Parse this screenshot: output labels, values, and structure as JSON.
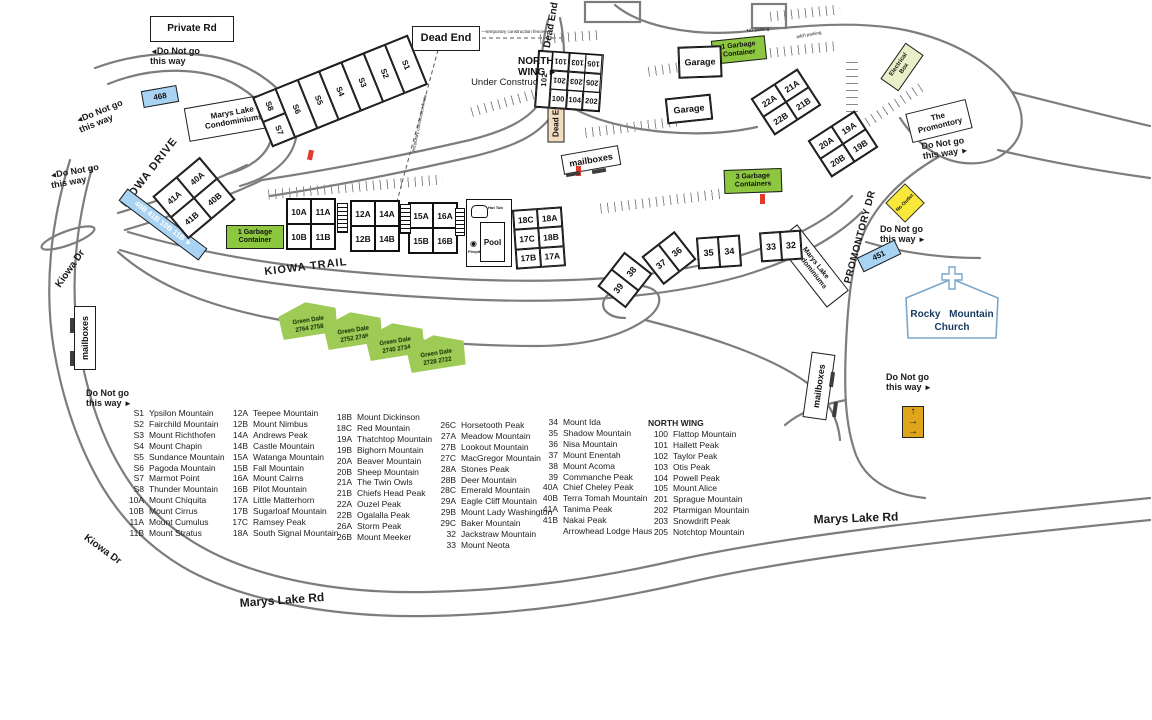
{
  "legend": {
    "columns": [
      {
        "x": 124,
        "y": 408,
        "header": "",
        "items": [
          {
            "code": "S1",
            "name": "Ypsilon Mountain"
          },
          {
            "code": "S2",
            "name": "Fairchild Mountain"
          },
          {
            "code": "S3",
            "name": "Mount Richthofen"
          },
          {
            "code": "S4",
            "name": "Mount Chapin"
          },
          {
            "code": "S5",
            "name": "Sundance Mountain"
          },
          {
            "code": "S6",
            "name": "Pagoda Mountain"
          },
          {
            "code": "S7",
            "name": "Marmot Point"
          },
          {
            "code": "S8",
            "name": "Thunder Mountain"
          },
          {
            "code": "10A",
            "name": "Mount Chiquita"
          },
          {
            "code": "10B",
            "name": "Mount Cirrus"
          },
          {
            "code": "11A",
            "name": "Mount Cumulus"
          },
          {
            "code": "11B",
            "name": "Mount Stratus"
          }
        ]
      },
      {
        "x": 228,
        "y": 408,
        "header": "",
        "items": [
          {
            "code": "12A",
            "name": "Teepee Mountain"
          },
          {
            "code": "12B",
            "name": "Mount Nimbus"
          },
          {
            "code": "14A",
            "name": "Andrews Peak"
          },
          {
            "code": "14B",
            "name": "Castle Mountain"
          },
          {
            "code": "15A",
            "name": "Watanga Mountain"
          },
          {
            "code": "15B",
            "name": "Fall Mountain"
          },
          {
            "code": "16A",
            "name": "Mount Cairns"
          },
          {
            "code": "16B",
            "name": "Pilot Mountain"
          },
          {
            "code": "17A",
            "name": "Little Matterhorn"
          },
          {
            "code": "17B",
            "name": "Sugarloaf Mountain"
          },
          {
            "code": "17C",
            "name": "Ramsey Peak"
          },
          {
            "code": "18A",
            "name": "South Signal Mountain"
          }
        ]
      },
      {
        "x": 332,
        "y": 412,
        "header": "",
        "items": [
          {
            "code": "18B",
            "name": "Mount Dickinson"
          },
          {
            "code": "18C",
            "name": "Red Mountain"
          },
          {
            "code": "19A",
            "name": "Thatchtop Mountain"
          },
          {
            "code": "19B",
            "name": "Bighorn Mountain"
          },
          {
            "code": "20A",
            "name": "Beaver Mountain"
          },
          {
            "code": "20B",
            "name": "Sheep Mountain"
          },
          {
            "code": "21A",
            "name": "The Twin Owls"
          },
          {
            "code": "21B",
            "name": "Chiefs Head Peak"
          },
          {
            "code": "22A",
            "name": "Ouzel Peak"
          },
          {
            "code": "22B",
            "name": "Ogalalla Peak"
          },
          {
            "code": "26A",
            "name": "Storm Peak"
          },
          {
            "code": "26B",
            "name": "Mount Meeker"
          }
        ]
      },
      {
        "x": 436,
        "y": 420,
        "header": "",
        "items": [
          {
            "code": "26C",
            "name": "Horsetooth Peak"
          },
          {
            "code": "27A",
            "name": "Meadow Mountain"
          },
          {
            "code": "27B",
            "name": "Lookout Mountain"
          },
          {
            "code": "27C",
            "name": "MacGregor Mountain"
          },
          {
            "code": "28A",
            "name": "Stones Peak"
          },
          {
            "code": "28B",
            "name": "Deer Mountain"
          },
          {
            "code": "28C",
            "name": "Emerald Mountain"
          },
          {
            "code": "29A",
            "name": "Eagle Cliff Mountain"
          },
          {
            "code": "29B",
            "name": "Mount Lady Washington"
          },
          {
            "code": "29C",
            "name": "Baker Mountain"
          },
          {
            "code": "32",
            "name": "Jackstraw Mountain"
          },
          {
            "code": "33",
            "name": "Mount Neota"
          }
        ]
      },
      {
        "x": 538,
        "y": 417,
        "header": "",
        "items": [
          {
            "code": "34",
            "name": "Mount Ida"
          },
          {
            "code": "35",
            "name": "Shadow Mountain"
          },
          {
            "code": "36",
            "name": "Nisa Mountain"
          },
          {
            "code": "37",
            "name": "Mount Enentah"
          },
          {
            "code": "38",
            "name": "Mount Acoma"
          },
          {
            "code": "39",
            "name": "Commanche Peak"
          },
          {
            "code": "40A",
            "name": "Chief Cheley Peak"
          },
          {
            "code": "40B",
            "name": "Terra Tomah Mountain"
          },
          {
            "code": "41A",
            "name": "Tanima Peak"
          },
          {
            "code": "41B",
            "name": "Nakai Peak"
          },
          {
            "code": "",
            "name": "Arrowhead Lodge Haus"
          }
        ]
      },
      {
        "x": 648,
        "y": 418,
        "header": "NORTH WING",
        "items": [
          {
            "code": "100",
            "name": "Flattop Mountain"
          },
          {
            "code": "101",
            "name": "Hallett Peak"
          },
          {
            "code": "102",
            "name": "Taylor Peak"
          },
          {
            "code": "103",
            "name": "Otis Peak"
          },
          {
            "code": "104",
            "name": "Powell Peak"
          },
          {
            "code": "105",
            "name": "Mount Alice"
          },
          {
            "code": "201",
            "name": "Sprague Mountain"
          },
          {
            "code": "202",
            "name": "Ptarmigan Mountain"
          },
          {
            "code": "203",
            "name": "Snowdrift Peak"
          },
          {
            "code": "205",
            "name": "Notchtop Mountain"
          }
        ]
      }
    ]
  },
  "map": {
    "colors": {
      "blue_sign": "#a9d3f2",
      "green_sign": "#8dc63f",
      "tan_sign": "#f2ddc0",
      "yellow_sign": "#f7e83a",
      "orange_sign": "#dfa61c",
      "khaki_sign": "#e9efc8",
      "red_marker": "#e23b2e"
    },
    "road_labels": [
      {
        "text": "KIOWA DRIVE",
        "x": 100,
        "y": 167,
        "w": 100,
        "rot": -52,
        "fs": 11,
        "sp": 1
      },
      {
        "text": "Kiowa Dr",
        "x": 38,
        "y": 264,
        "w": 66,
        "rot": -55,
        "fs": 10
      },
      {
        "text": "Kiowa Dr",
        "x": 70,
        "y": 545,
        "w": 64,
        "rot": 36,
        "fs": 10
      },
      {
        "text": "KIOWA TRAIL",
        "x": 258,
        "y": 262,
        "w": 96,
        "rot": -7,
        "fs": 11,
        "sp": 1
      },
      {
        "text": "Marys Lake Rd",
        "x": 226,
        "y": 594,
        "w": 112,
        "rot": -4,
        "fs": 12
      },
      {
        "text": "Marys Lake Rd",
        "x": 800,
        "y": 512,
        "w": 112,
        "rot": -2,
        "fs": 12
      },
      {
        "text": "PROMONTORY DR",
        "x": 806,
        "y": 232,
        "w": 110,
        "rot": -75,
        "fs": 10,
        "sp": 0.5
      },
      {
        "text": "Dead End",
        "x": 520,
        "y": 20,
        "w": 64,
        "rot": -80,
        "fs": 10
      },
      {
        "text": "Under Construction",
        "x": 452,
        "y": 78,
        "w": 120,
        "rot": 0,
        "fs": 9.5,
        "wt": 400
      },
      {
        "text": "—temporary construction fence—",
        "x": 455,
        "y": 30,
        "w": 120,
        "rot": 0,
        "fs": 4.5,
        "wt": 400
      },
      {
        "text": "temporary construction fence",
        "x": 370,
        "y": 121,
        "w": 100,
        "rot": -78,
        "fs": 4.5,
        "wt": 400
      },
      {
        "text": "NO parking",
        "x": 733,
        "y": 28,
        "w": 50,
        "rot": -5,
        "fs": 4.5,
        "wt": 400
      },
      {
        "text": "add'l parking",
        "x": 784,
        "y": 33,
        "w": 50,
        "rot": -10,
        "fs": 4.5,
        "wt": 400
      }
    ],
    "do_not_go": [
      {
        "x": 150,
        "y": 46,
        "rot": 0,
        "pre": "◄",
        "post": "",
        "l1": "Do Not go",
        "l2": "this way"
      },
      {
        "x": 76,
        "y": 106,
        "rot": -22,
        "pre": "◄",
        "post": "",
        "l1": "Do Not go",
        "l2": "this way"
      },
      {
        "x": 50,
        "y": 166,
        "rot": -10,
        "pre": "◄",
        "post": "",
        "l1": "Do Not go",
        "l2": "this way"
      },
      {
        "x": 86,
        "y": 388,
        "rot": 0,
        "pre": "",
        "post": "►",
        "l1": "Do Not go",
        "l2": "this way"
      },
      {
        "x": 922,
        "y": 138,
        "rot": -8,
        "pre": "",
        "post": "►",
        "l1": "Do Not go",
        "l2": "this way"
      },
      {
        "x": 880,
        "y": 224,
        "rot": 0,
        "pre": "",
        "post": "►",
        "l1": "Do Not go",
        "l2": "this way"
      },
      {
        "x": 886,
        "y": 372,
        "rot": 0,
        "pre": "",
        "post": "►",
        "l1": "Do Not go",
        "l2": "this way"
      }
    ],
    "signs": [
      {
        "dn": "sign-private-rd",
        "lines": [
          "Private Rd"
        ],
        "x": 150,
        "y": 16,
        "w": 84,
        "h": 26,
        "rot": 0,
        "fs": 10,
        "bg": "#ffffff"
      },
      {
        "dn": "sign-dead-end",
        "lines": [
          "Dead End"
        ],
        "x": 412,
        "y": 26,
        "w": 68,
        "h": 25,
        "rot": 0,
        "fs": 11,
        "bg": "#ffffff"
      },
      {
        "dn": "sign-marys-lake-condominiums",
        "lines": [
          "Marys Lake",
          "Condominiums"
        ],
        "x": 186,
        "y": 100,
        "w": 94,
        "h": 34,
        "rot": -10,
        "fs": 8,
        "bg": "#ffffff"
      },
      {
        "dn": "sign-the-promontory",
        "lines": [
          "The",
          "Promontory"
        ],
        "x": 908,
        "y": 106,
        "w": 62,
        "h": 30,
        "rot": -14,
        "fs": 8,
        "bg": "#ffffff"
      },
      {
        "dn": "sign-marys-lake-condominiums",
        "lines": [
          "Marys Lake",
          "Condominiums"
        ],
        "x": 770,
        "y": 252,
        "w": 84,
        "h": 28,
        "rot": 52,
        "fs": 7,
        "bg": "#ffffff"
      },
      {
        "dn": "sign-mailboxes",
        "lines": [
          "mailboxes"
        ],
        "x": 562,
        "y": 150,
        "w": 58,
        "h": 20,
        "rot": -10,
        "fs": 9,
        "bg": "#ffffff"
      },
      {
        "dn": "sign-mailboxes",
        "lines": [
          "mailboxes"
        ],
        "x": 53,
        "y": 327,
        "w": 64,
        "h": 22,
        "rot": -90,
        "fs": 9,
        "bg": "#ffffff"
      },
      {
        "dn": "sign-mailboxes",
        "lines": [
          "mailboxes"
        ],
        "x": 786,
        "y": 374,
        "w": 66,
        "h": 24,
        "rot": -82,
        "fs": 9,
        "bg": "#ffffff"
      },
      {
        "dn": "sign-dead-end",
        "lines": [
          "Dead End"
        ],
        "x": 532,
        "y": 110,
        "w": 48,
        "h": 17,
        "rot": -90,
        "fs": 8,
        "bg": "#f2ddc0"
      },
      {
        "dn": "sign-electrical-box",
        "lines": [
          "Electrical",
          "Box"
        ],
        "x": 880,
        "y": 56,
        "w": 44,
        "h": 22,
        "rot": -55,
        "fs": 6,
        "bg": "#e9efc8"
      },
      {
        "dn": "sign-468",
        "lines": [
          "468"
        ],
        "x": 142,
        "y": 88,
        "w": 36,
        "h": 17,
        "rot": -10,
        "fs": 8,
        "bg": "#a9d3f2"
      },
      {
        "dn": "sign-451",
        "lines": [
          "451"
        ],
        "x": 858,
        "y": 248,
        "w": 42,
        "h": 16,
        "rot": -26,
        "fs": 8,
        "bg": "#a9d3f2"
      },
      {
        "dn": "sign-units-direction",
        "lines": [
          "40B 41B 10B 11B ►"
        ],
        "x": 113,
        "y": 217,
        "w": 100,
        "h": 15,
        "rot": 37,
        "fs": 7.5,
        "bg": "#a9d3f2",
        "fg": "#ffffff"
      },
      {
        "dn": "sign-garbage-container",
        "lines": [
          "1 Garbage",
          "Container"
        ],
        "x": 712,
        "y": 38,
        "w": 54,
        "h": 24,
        "rot": -6,
        "fs": 7,
        "bg": "#8dc63f"
      },
      {
        "dn": "sign-garbage-container",
        "lines": [
          "1 Garbage",
          "Container"
        ],
        "x": 226,
        "y": 225,
        "w": 58,
        "h": 24,
        "rot": 0,
        "fs": 7,
        "bg": "#8dc63f"
      },
      {
        "dn": "sign-garbage-containers",
        "lines": [
          "3 Garbage",
          "Containers"
        ],
        "x": 724,
        "y": 169,
        "w": 58,
        "h": 24,
        "rot": -2,
        "fs": 7,
        "bg": "#8dc63f"
      }
    ],
    "green_dale": [
      {
        "l1": "Green Dale",
        "l2": "2764  2758",
        "x": 279,
        "y": 302,
        "rot": -9
      },
      {
        "l1": "Green Dale",
        "l2": "2752  2746",
        "x": 324,
        "y": 312,
        "rot": -9
      },
      {
        "l1": "Green Dale",
        "l2": "2740  2734",
        "x": 366,
        "y": 323,
        "rot": -9
      },
      {
        "l1": "Green Dale",
        "l2": "2728  2722",
        "x": 407,
        "y": 335,
        "rot": -9
      }
    ],
    "buildings": [
      {
        "dn": "building-40-41",
        "x": 163,
        "y": 170,
        "w": 62,
        "h": 56,
        "rot": -40,
        "cols": 2,
        "fs": 8.5,
        "units": [
          "41A",
          "40A",
          "41B",
          "40B"
        ]
      },
      {
        "dn": "building-10-11",
        "x": 286,
        "y": 198,
        "w": 50,
        "h": 52,
        "rot": 0,
        "cols": 2,
        "fs": 8.5,
        "units": [
          "10A",
          "11A",
          "10B",
          "11B"
        ]
      },
      {
        "dn": "building-12-14",
        "x": 350,
        "y": 200,
        "w": 50,
        "h": 52,
        "rot": 0,
        "cols": 2,
        "fs": 8.5,
        "units": [
          "12A",
          "14A",
          "12B",
          "14B"
        ]
      },
      {
        "dn": "building-15-16",
        "x": 408,
        "y": 202,
        "w": 50,
        "h": 52,
        "rot": 0,
        "cols": 2,
        "fs": 8.5,
        "units": [
          "15A",
          "16A",
          "15B",
          "16B"
        ]
      },
      {
        "dn": "building-17-18",
        "x": 514,
        "y": 208,
        "w": 50,
        "h": 60,
        "rot": -4,
        "cols": 2,
        "fs": 8.5,
        "units": [
          "18C",
          "18A",
          "17C",
          "18B",
          "17B",
          "17A"
        ]
      },
      {
        "dn": "building-21-22",
        "x": 758,
        "y": 80,
        "w": 56,
        "h": 44,
        "rot": -33,
        "cols": 2,
        "fs": 8.5,
        "units": [
          "22A",
          "21A",
          "22B",
          "21B"
        ]
      },
      {
        "dn": "building-19-20",
        "x": 815,
        "y": 122,
        "w": 56,
        "h": 44,
        "rot": -33,
        "cols": 2,
        "fs": 8.5,
        "units": [
          "20A",
          "19A",
          "20B",
          "19B"
        ]
      },
      {
        "dn": "building-38-39",
        "x": 603,
        "y": 262,
        "w": 44,
        "h": 36,
        "rot": -52,
        "cols": 2,
        "fs": 9,
        "units": [
          "39",
          "38"
        ]
      },
      {
        "dn": "building-36-37",
        "x": 648,
        "y": 240,
        "w": 42,
        "h": 36,
        "rot": -38,
        "cols": 2,
        "fs": 9,
        "units": [
          "37",
          "36"
        ]
      },
      {
        "dn": "building-34-35",
        "x": 697,
        "y": 236,
        "w": 44,
        "h": 32,
        "rot": -4,
        "cols": 2,
        "fs": 9,
        "units": [
          "35",
          "34"
        ]
      },
      {
        "dn": "building-32-33",
        "x": 760,
        "y": 231,
        "w": 42,
        "h": 30,
        "rot": -4,
        "cols": 2,
        "fs": 9,
        "units": [
          "33",
          "32"
        ]
      },
      {
        "dn": "building-garage",
        "x": 678,
        "y": 46,
        "w": 44,
        "h": 32,
        "rot": -2,
        "cols": 1,
        "fs": 9,
        "units": [
          "Garage"
        ]
      },
      {
        "dn": "building-garage",
        "x": 666,
        "y": 96,
        "w": 46,
        "h": 26,
        "rot": -6,
        "cols": 1,
        "fs": 9,
        "units": [
          "Garage"
        ]
      }
    ],
    "s_building": {
      "x": 256,
      "y": 64,
      "w": 168,
      "h": 54,
      "rot": -22,
      "left_top": "S8",
      "left_bottom": "S7",
      "row": [
        "S6",
        "S5",
        "S4",
        "S3",
        "S2",
        "S1"
      ]
    },
    "north_wing": {
      "x": 536,
      "y": 52,
      "w": 66,
      "h": 58,
      "rot": 4,
      "side": "102",
      "rows": [
        [
          "101",
          "103",
          "105"
        ],
        [
          "201",
          "203",
          "205"
        ],
        [
          "100",
          "104",
          "202"
        ]
      ]
    },
    "north_wing_label": {
      "x": 518,
      "y": 56,
      "l1": "NORTH",
      "l2": "WING",
      "arrow": "►"
    },
    "pool": {
      "x": 466,
      "y": 199,
      "w": 46,
      "h": 68,
      "hot_tub": "Hot Tub",
      "pool": "Pool",
      "firepit": "Firepit"
    },
    "church": {
      "x": 900,
      "y": 266,
      "w": 104,
      "h": 74,
      "line1": "Rocky Mountain",
      "line2": "Church"
    },
    "no_outlet": {
      "x": 891,
      "y": 189,
      "w": 28,
      "h": 28,
      "text": "No Outlet"
    },
    "dir_sign": {
      "x": 902,
      "y": 406,
      "w": 22,
      "h": 32,
      "arrows": [
        "↑",
        "→",
        "→"
      ]
    },
    "red_marks": [
      {
        "x": 308,
        "y": 150,
        "rot": 12
      },
      {
        "x": 576,
        "y": 166,
        "rot": 0
      },
      {
        "x": 760,
        "y": 194,
        "rot": 0
      }
    ],
    "stairs": [
      {
        "x": 337,
        "y": 203,
        "w": 11,
        "h": 30
      },
      {
        "x": 400,
        "y": 204,
        "w": 11,
        "h": 30
      },
      {
        "x": 455,
        "y": 208,
        "w": 10,
        "h": 28
      }
    ]
  }
}
